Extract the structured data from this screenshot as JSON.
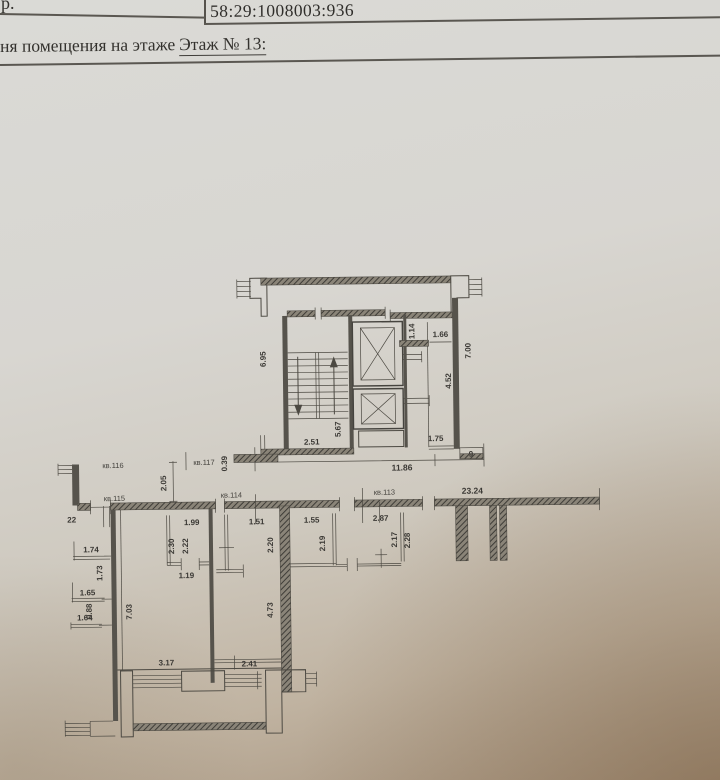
{
  "header": {
    "doc_fragment": "р.",
    "cadastral_number": "58:29:1008003:936",
    "caption_prefix": "ня помещения на этаже",
    "floor_label": "Этаж № 13:"
  },
  "plan": {
    "apartments": {
      "kv116": "кв.116",
      "kv117": "кв.117",
      "kv115": "кв.115",
      "kv114": "кв.114",
      "kv113": "кв.113"
    },
    "dims": {
      "stair_width": "2.51",
      "stair_depth": "5.67",
      "stair_side": "6.95",
      "lift_niche": "1.14",
      "lift_room": "1.66",
      "core_right": "7.00",
      "core_inner": "4.52",
      "core_bottom_right": "1.75",
      "core_bottom_total": "11.86",
      "niche": "0.39",
      "small_nine": "9",
      "gap": "2.05",
      "total_width": "23.24",
      "wall_mark": "22",
      "room_a_w": "1.99",
      "room_b_w": "1.51",
      "room_c_w": "1.55",
      "room_d_w": "2.87",
      "h_230": "2.30",
      "h_222": "2.22",
      "h_220": "2.20",
      "h_219": "2.19",
      "h_217": "2.17",
      "h_228": "2.28",
      "w_119": "1.19",
      "bay_174": "1.74",
      "bay_173": "1.73",
      "bay_165": "1.65",
      "bay_088": "0.88",
      "bay_164": "1.64",
      "depth_703": "7.03",
      "depth_473": "4.73",
      "bottom_317": "3.17",
      "bottom_241": "2.41"
    }
  }
}
